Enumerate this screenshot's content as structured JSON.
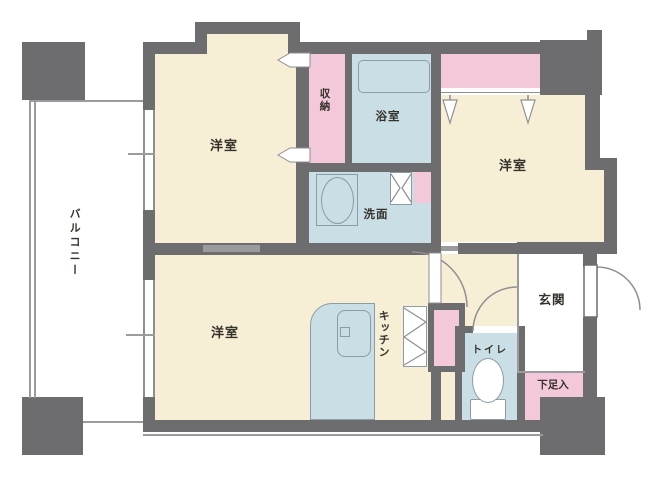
{
  "plan": {
    "type": "floor-plan",
    "labels": {
      "balcony": "バルコニー",
      "bedroom_top": "洋室",
      "storage": "収納",
      "bathroom": "浴室",
      "bedroom_right": "洋室",
      "washroom": "洗面",
      "bedroom_bottom": "洋室",
      "kitchen": "キッチン",
      "toilet": "トイレ",
      "entrance": "玄関",
      "shoe_cabinet": "下足入"
    },
    "colors": {
      "wall": "#6d6d6f",
      "room_floor": "#f6eed5",
      "closet_pink": "#f3c8da",
      "wet_area_blue": "#c9dee5",
      "outdoor_white": "#ffffff",
      "label_text": "#35312b",
      "thin_line": "#9b9b9d"
    }
  }
}
